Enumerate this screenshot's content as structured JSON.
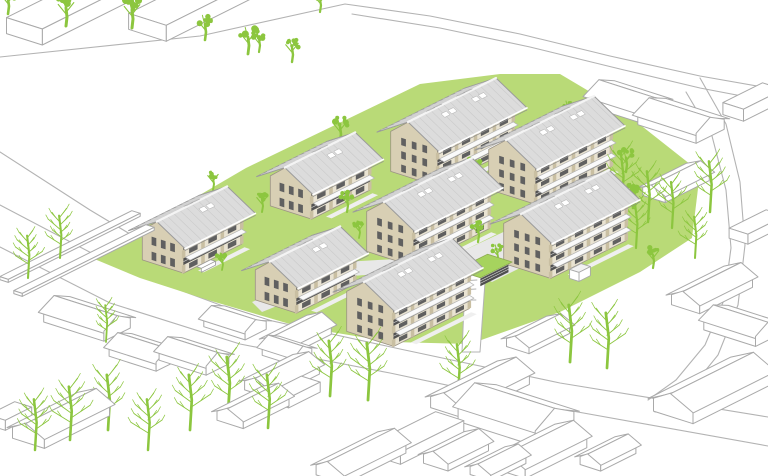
{
  "scene": {
    "type": "axonometric-residential-site-plan",
    "chalet_count": 8,
    "orientation": "planometric"
  },
  "colors": {
    "background": "#ffffff",
    "lawn": "#b9da77",
    "tree_green": "#8cc63f",
    "roof_fill": "#dcdcdc",
    "roof_stroke": "#9b9b9b",
    "roof_seam": "#cbcbcb",
    "ridge": "#f4f4f4",
    "wall_beige": "#d8cfb4",
    "wall_beige_dark": "#c9bfa2",
    "facade_light": "#e9e3d2",
    "band_dark": "#535353",
    "shadow_dark": "#6e6e6e",
    "window_dark": "#606060",
    "context_stroke": "#a9a9a9",
    "road_stroke": "#b3b3b3",
    "path_fill": "#e8e8e8",
    "walk_fill": "#efefef",
    "white": "#ffffff",
    "slab_white": "#fafafa",
    "carport_roof": "#a6d35e",
    "carport_dark": "#4f4f4f"
  },
  "chalet_params": {
    "small": {
      "L": 66,
      "W": 44,
      "wallH": 30,
      "rise": 18,
      "floors": 2,
      "bays": 3
    },
    "large": {
      "L": 86,
      "W": 50,
      "wallH": 40,
      "rise": 20,
      "floors": 3,
      "bays": 4
    }
  },
  "chalets": [
    {
      "id": "A1",
      "size": "small",
      "cx": 192,
      "cy": 252
    },
    {
      "id": "A2",
      "size": "small",
      "cx": 320,
      "cy": 198
    },
    {
      "id": "A3",
      "size": "small",
      "cx": 305,
      "cy": 292
    },
    {
      "id": "B1",
      "size": "large",
      "cx": 452,
      "cy": 160
    },
    {
      "id": "B2",
      "size": "large",
      "cx": 550,
      "cy": 178
    },
    {
      "id": "B3",
      "size": "large",
      "cx": 428,
      "cy": 240
    },
    {
      "id": "B4",
      "size": "large",
      "cx": 565,
      "cy": 252
    },
    {
      "id": "B5",
      "size": "large",
      "cx": 408,
      "cy": 320
    }
  ],
  "carport": {
    "cx": 484,
    "cy": 276,
    "l": 32,
    "w": 22,
    "h": 10
  },
  "shed": {
    "cx": 580,
    "cy": 277,
    "l": 13,
    "w": 10,
    "h": 9
  },
  "bench": {
    "cx": 206,
    "cy": 268,
    "l": 16,
    "w": 5,
    "h": 4
  },
  "site": {
    "lawn": [
      [
        92,
        258
      ],
      [
        140,
        278
      ],
      [
        208,
        300
      ],
      [
        300,
        327
      ],
      [
        392,
        342
      ],
      [
        470,
        344
      ],
      [
        560,
        312
      ],
      [
        640,
        272
      ],
      [
        692,
        238
      ],
      [
        700,
        172
      ],
      [
        624,
        112
      ],
      [
        560,
        74
      ],
      [
        500,
        74
      ],
      [
        420,
        84
      ],
      [
        246,
        168
      ]
    ],
    "court": [
      [
        448,
        258
      ],
      [
        512,
        228
      ],
      [
        556,
        250
      ],
      [
        492,
        282
      ]
    ],
    "spine": [
      [
        252,
        302
      ],
      [
        344,
        262
      ],
      [
        448,
        256
      ],
      [
        456,
        268
      ],
      [
        352,
        276
      ],
      [
        262,
        312
      ]
    ],
    "driveway": [
      [
        462,
        352
      ],
      [
        480,
        352
      ],
      [
        486,
        268
      ],
      [
        466,
        262
      ]
    ],
    "drive_hatch": [
      [
        [
          456,
          300
        ],
        [
          476,
          300
        ]
      ],
      [
        [
          455,
          290
        ],
        [
          476,
          289
        ]
      ],
      [
        [
          455,
          281
        ],
        [
          477,
          280
        ]
      ],
      [
        [
          458,
          273
        ],
        [
          479,
          271
        ]
      ],
      [
        [
          461,
          266
        ],
        [
          482,
          264
        ]
      ]
    ],
    "roads": [
      [
        [
          0,
          205
        ],
        [
          120,
          268
        ],
        [
          250,
          316
        ],
        [
          400,
          349
        ],
        [
          560,
          383
        ],
        [
          768,
          417
        ]
      ],
      [
        [
          0,
          247
        ],
        [
          110,
          303
        ],
        [
          240,
          344
        ],
        [
          390,
          373
        ],
        [
          550,
          407
        ],
        [
          768,
          446
        ]
      ],
      [
        [
          0,
          57
        ],
        [
          200,
          36
        ],
        [
          345,
          4
        ],
        [
          430,
          16
        ],
        [
          520,
          34
        ],
        [
          610,
          56
        ],
        [
          700,
          76
        ],
        [
          768,
          88
        ]
      ],
      [
        [
          352,
          14
        ],
        [
          440,
          28
        ],
        [
          530,
          47
        ],
        [
          620,
          69
        ],
        [
          700,
          88
        ],
        [
          768,
          101
        ]
      ],
      [
        [
          700,
          78
        ],
        [
          726,
          124
        ],
        [
          740,
          182
        ],
        [
          745,
          245
        ],
        [
          738,
          305
        ],
        [
          718,
          355
        ],
        [
          688,
          392
        ],
        [
          655,
          412
        ]
      ],
      [
        [
          686,
          92
        ],
        [
          712,
          136
        ],
        [
          726,
          190
        ],
        [
          731,
          248
        ],
        [
          724,
          300
        ],
        [
          705,
          345
        ],
        [
          676,
          380
        ],
        [
          648,
          400
        ]
      ],
      [
        [
          0,
          152
        ],
        [
          90,
          210
        ],
        [
          170,
          258
        ],
        [
          230,
          295
        ]
      ]
    ]
  },
  "context_buildings": [
    {
      "cx": 75,
      "cy": 14,
      "l": 115,
      "w": 38,
      "h": 16,
      "r": 0,
      "axis": "ex",
      "type": "slab"
    },
    {
      "cx": 198,
      "cy": 10,
      "l": 115,
      "w": 40,
      "h": 16,
      "r": 0,
      "axis": "ex",
      "type": "slab"
    },
    {
      "cx": 628,
      "cy": 108,
      "l": 56,
      "w": 30,
      "h": 10,
      "r": 9,
      "axis": "ey",
      "type": "gable"
    },
    {
      "cx": 681,
      "cy": 127,
      "l": 62,
      "w": 32,
      "h": 10,
      "r": 9,
      "axis": "ey",
      "type": "gable"
    },
    {
      "cx": 753,
      "cy": 108,
      "l": 45,
      "w": 22,
      "h": 12,
      "r": 0,
      "axis": "ey",
      "type": "slab"
    },
    {
      "cx": 676,
      "cy": 188,
      "l": 50,
      "w": 24,
      "h": 8,
      "r": 7,
      "axis": "ex",
      "type": "gable"
    },
    {
      "cx": 757,
      "cy": 232,
      "l": 42,
      "w": 20,
      "h": 10,
      "r": 0,
      "axis": "ex",
      "type": "slab"
    },
    {
      "cx": 70,
      "cy": 248,
      "l": 150,
      "w": 9,
      "h": 3,
      "r": 0,
      "axis": "ey",
      "type": "slab"
    },
    {
      "cx": 84,
      "cy": 262,
      "l": 150,
      "w": 9,
      "h": 3,
      "r": 0,
      "axis": "ey",
      "type": "slab"
    },
    {
      "cx": 712,
      "cy": 296,
      "l": 60,
      "w": 30,
      "h": 10,
      "r": 9,
      "axis": "ex",
      "type": "gable"
    },
    {
      "cx": 742,
      "cy": 332,
      "l": 55,
      "w": 28,
      "h": 10,
      "r": 8,
      "axis": "ey",
      "type": "gable"
    },
    {
      "cx": 712,
      "cy": 398,
      "l": 88,
      "w": 42,
      "h": 13,
      "r": 12,
      "axis": "ex",
      "type": "gable"
    },
    {
      "cx": 87,
      "cy": 325,
      "l": 64,
      "w": 30,
      "h": 10,
      "r": 9,
      "axis": "ey",
      "type": "gable"
    },
    {
      "cx": 144,
      "cy": 358,
      "l": 50,
      "w": 26,
      "h": 9,
      "r": 8,
      "axis": "ey",
      "type": "gable"
    },
    {
      "cx": 194,
      "cy": 362,
      "l": 50,
      "w": 26,
      "h": 9,
      "r": 8,
      "axis": "ey",
      "type": "gable"
    },
    {
      "cx": 235,
      "cy": 328,
      "l": 44,
      "w": 24,
      "h": 8,
      "r": 7,
      "axis": "ey",
      "type": "gable"
    },
    {
      "cx": 287,
      "cy": 356,
      "l": 34,
      "w": 20,
      "h": 8,
      "r": 7,
      "axis": "ey",
      "type": "gable"
    },
    {
      "cx": 298,
      "cy": 341,
      "l": 48,
      "w": 26,
      "h": 9,
      "r": 8,
      "axis": "ex",
      "type": "gable"
    },
    {
      "cx": 282,
      "cy": 382,
      "l": 55,
      "w": 28,
      "h": 9,
      "r": 8,
      "axis": "ex",
      "type": "gable"
    },
    {
      "cx": 253,
      "cy": 413,
      "l": 52,
      "w": 28,
      "h": 9,
      "r": 8,
      "axis": "ex",
      "type": "gable"
    },
    {
      "cx": 61,
      "cy": 427,
      "l": 74,
      "w": 34,
      "h": 11,
      "r": 10,
      "axis": "ex",
      "type": "gable"
    },
    {
      "cx": 10,
      "cy": 421,
      "l": 30,
      "w": 18,
      "h": 10,
      "r": 0,
      "axis": "ex",
      "type": "slab"
    },
    {
      "cx": 538,
      "cy": 340,
      "l": 46,
      "w": 24,
      "h": 8,
      "r": 7,
      "axis": "ex",
      "type": "gable"
    },
    {
      "cx": 516,
      "cy": 424,
      "l": 82,
      "w": 44,
      "h": 15,
      "r": 13,
      "axis": "ey",
      "type": "gable"
    },
    {
      "cx": 540,
      "cy": 458,
      "l": 70,
      "w": 34,
      "h": 11,
      "r": 10,
      "axis": "ex",
      "type": "gable"
    },
    {
      "cx": 608,
      "cy": 459,
      "l": 40,
      "w": 22,
      "h": 8,
      "r": 7,
      "axis": "ex",
      "type": "gable"
    },
    {
      "cx": 418,
      "cy": 444,
      "l": 72,
      "w": 30,
      "h": 12,
      "r": 0,
      "axis": "ex",
      "type": "slab"
    },
    {
      "cx": 456,
      "cy": 457,
      "l": 46,
      "w": 26,
      "h": 9,
      "r": 8,
      "axis": "ex",
      "type": "gable"
    },
    {
      "cx": 480,
      "cy": 396,
      "l": 76,
      "w": 34,
      "h": 11,
      "r": 10,
      "axis": "ex",
      "type": "gable"
    },
    {
      "cx": 361,
      "cy": 464,
      "l": 70,
      "w": 30,
      "h": 10,
      "r": 9,
      "axis": "ex",
      "type": "gable"
    },
    {
      "cx": 498,
      "cy": 469,
      "l": 40,
      "w": 22,
      "h": 8,
      "r": 7,
      "axis": "ex",
      "type": "gable"
    },
    {
      "cx": 295,
      "cy": 397,
      "l": 36,
      "w": 20,
      "h": 10,
      "r": 0,
      "axis": "ex",
      "type": "slab"
    }
  ],
  "trees": {
    "solid": [
      [
        8,
        14,
        26
      ],
      [
        66,
        26,
        30
      ],
      [
        132,
        28,
        30
      ],
      [
        170,
        12,
        22
      ],
      [
        205,
        40,
        26
      ],
      [
        248,
        54,
        28
      ],
      [
        292,
        62,
        24
      ],
      [
        320,
        12,
        22
      ],
      [
        259,
        52,
        22
      ],
      [
        340,
        142,
        26
      ],
      [
        347,
        212,
        22
      ],
      [
        359,
        238,
        18
      ],
      [
        213,
        190,
        20
      ],
      [
        222,
        270,
        18
      ],
      [
        262,
        212,
        20
      ],
      [
        503,
        126,
        20
      ],
      [
        475,
        180,
        22
      ],
      [
        478,
        242,
        22
      ],
      [
        497,
        262,
        18
      ],
      [
        568,
        120,
        20
      ],
      [
        626,
        172,
        24
      ],
      [
        633,
        208,
        26
      ],
      [
        653,
        268,
        22
      ]
    ],
    "skeleton": [
      [
        28,
        278,
        46
      ],
      [
        60,
        258,
        46
      ],
      [
        106,
        342,
        40
      ],
      [
        35,
        450,
        55
      ],
      [
        70,
        440,
        58
      ],
      [
        108,
        430,
        60
      ],
      [
        148,
        450,
        55
      ],
      [
        190,
        430,
        60
      ],
      [
        228,
        414,
        62
      ],
      [
        268,
        428,
        58
      ],
      [
        330,
        396,
        60
      ],
      [
        368,
        400,
        62
      ],
      [
        458,
        395,
        55
      ],
      [
        570,
        362,
        62
      ],
      [
        607,
        368,
        60
      ],
      [
        622,
        202,
        52
      ],
      [
        648,
        222,
        55
      ],
      [
        672,
        228,
        50
      ],
      [
        710,
        212,
        55
      ],
      [
        695,
        258,
        45
      ],
      [
        636,
        248,
        48
      ]
    ]
  }
}
